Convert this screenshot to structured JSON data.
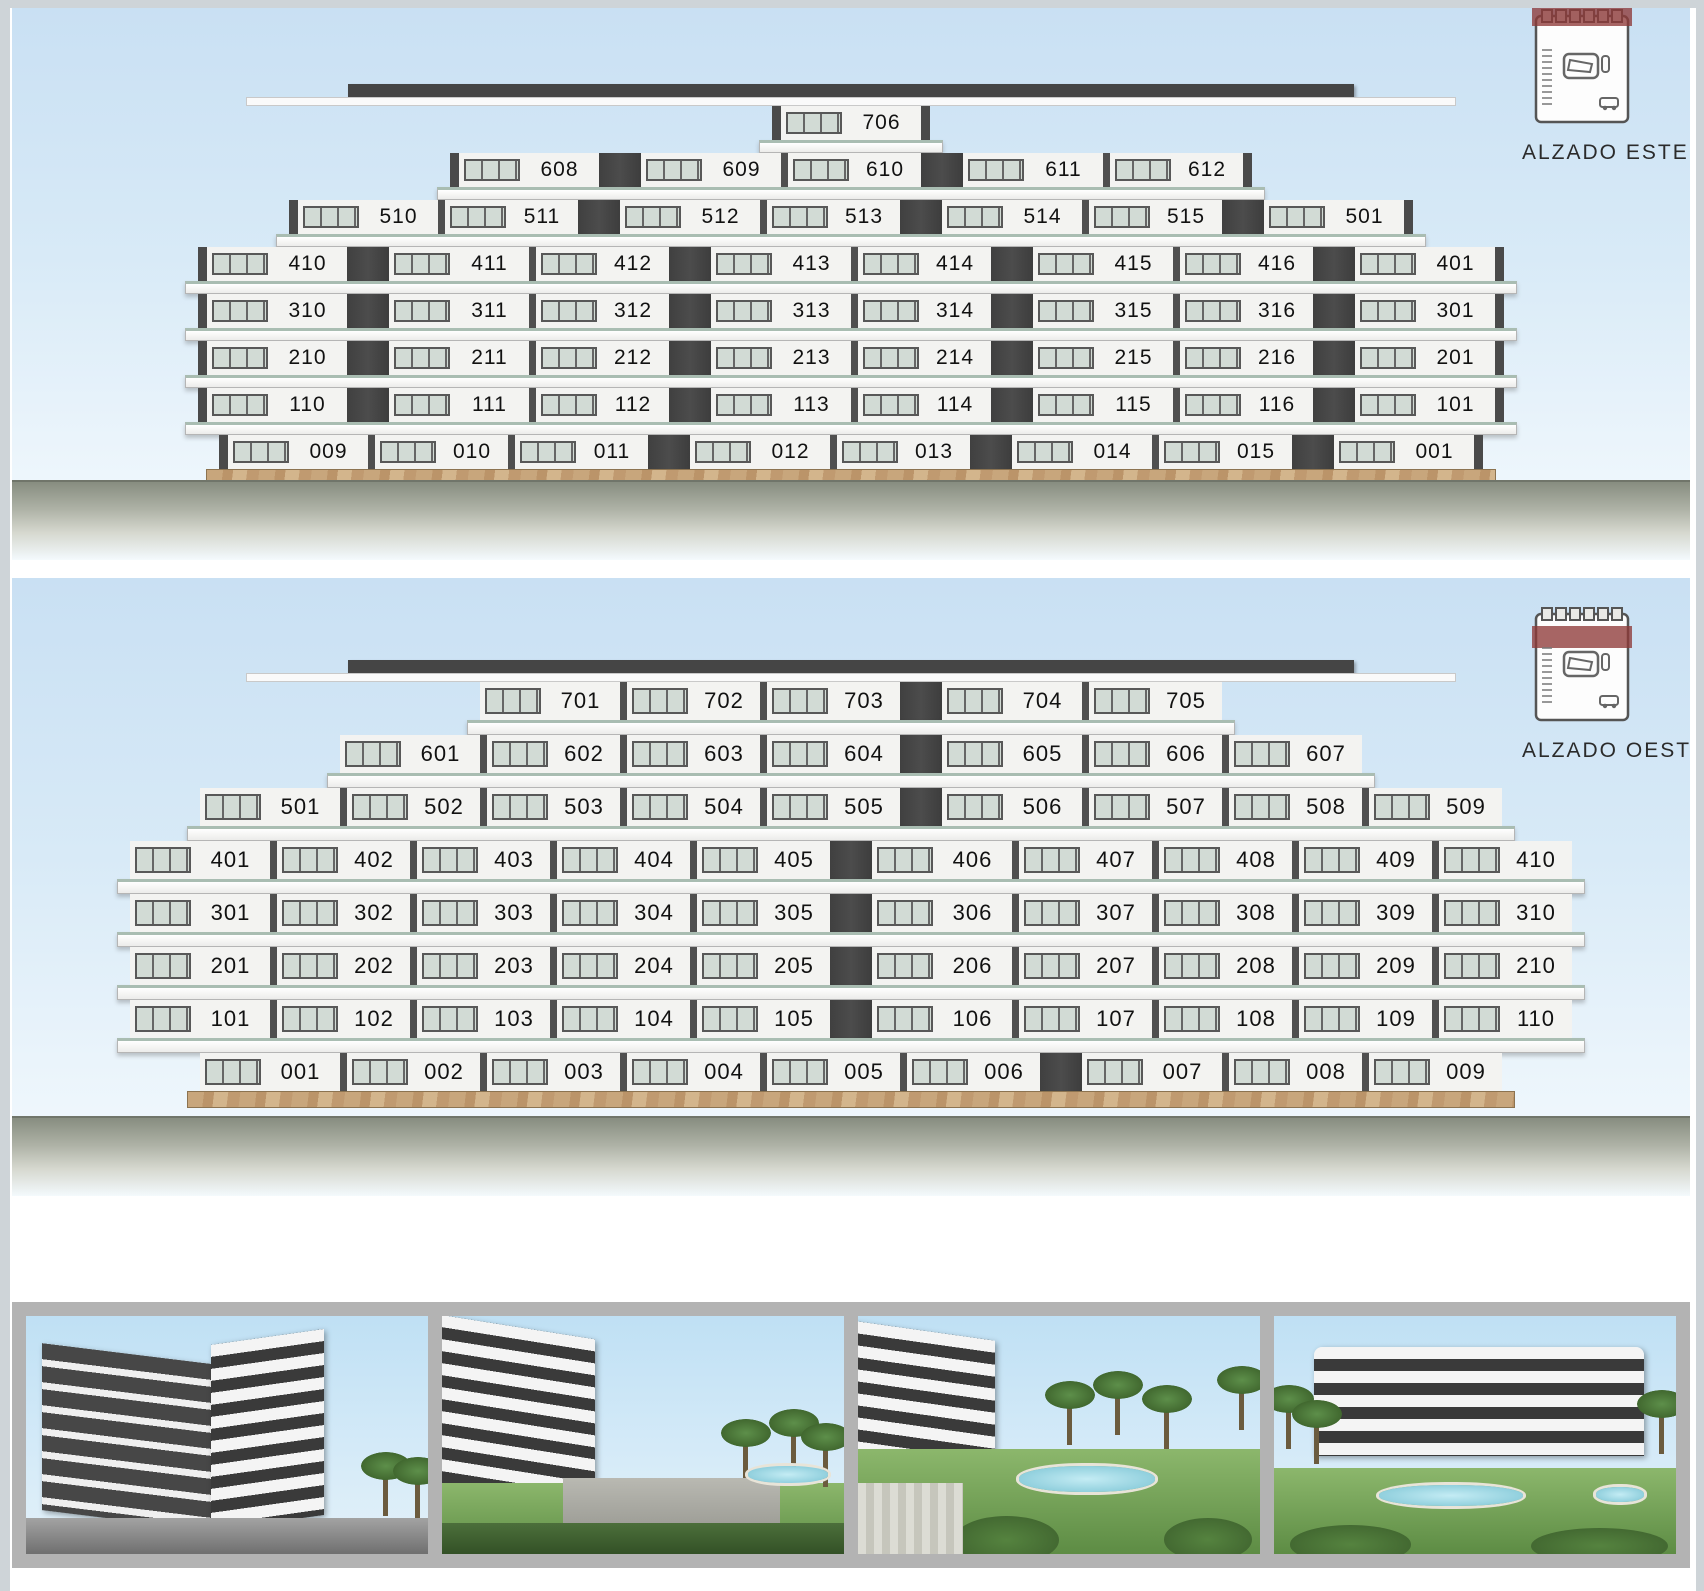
{
  "panels": [
    {
      "id": "este",
      "label": "ALZADO ESTE",
      "floors": [
        [
          "706"
        ],
        [
          "608",
          "|",
          "609",
          "610",
          "|",
          "611",
          "612"
        ],
        [
          "510",
          "511",
          "|",
          "512",
          "513",
          "|",
          "514",
          "515",
          "|",
          "501"
        ],
        [
          "410",
          "|",
          "411",
          "412",
          "|",
          "413",
          "414",
          "|",
          "415",
          "416",
          "|",
          "401"
        ],
        [
          "310",
          "|",
          "311",
          "312",
          "|",
          "313",
          "314",
          "|",
          "315",
          "316",
          "|",
          "301"
        ],
        [
          "210",
          "|",
          "211",
          "212",
          "|",
          "213",
          "214",
          "|",
          "215",
          "216",
          "|",
          "201"
        ],
        [
          "110",
          "|",
          "111",
          "112",
          "|",
          "113",
          "114",
          "|",
          "115",
          "116",
          "|",
          "101"
        ],
        [
          "009",
          "010",
          "011",
          "|",
          "012",
          "013",
          "|",
          "014",
          "015",
          "|",
          "001"
        ]
      ]
    },
    {
      "id": "oeste",
      "label": "ALZADO OESTE",
      "floors": [
        [
          "701",
          "702",
          "703",
          "|",
          "704",
          "705"
        ],
        [
          "601",
          "602",
          "603",
          "604",
          "|",
          "605",
          "606",
          "607"
        ],
        [
          "501",
          "502",
          "503",
          "504",
          "505",
          "|",
          "506",
          "507",
          "508",
          "509"
        ],
        [
          "401",
          "402",
          "403",
          "404",
          "405",
          "|",
          "406",
          "407",
          "408",
          "409",
          "410"
        ],
        [
          "301",
          "302",
          "303",
          "304",
          "305",
          "|",
          "306",
          "307",
          "308",
          "309",
          "310"
        ],
        [
          "201",
          "202",
          "203",
          "204",
          "205",
          "|",
          "206",
          "207",
          "208",
          "209",
          "210"
        ],
        [
          "101",
          "102",
          "103",
          "104",
          "105",
          "|",
          "106",
          "107",
          "108",
          "109",
          "110"
        ],
        [
          "001",
          "002",
          "003",
          "004",
          "005",
          "006",
          "|",
          "007",
          "008",
          "009"
        ]
      ]
    }
  ],
  "photos": [
    {
      "name": "street-corner-view-render"
    },
    {
      "name": "facade-promenade-render"
    },
    {
      "name": "garden-pool-render"
    },
    {
      "name": "building-with-pool-garden-render"
    }
  ],
  "colors": {
    "sky": "#cfe3f4",
    "facade_dark": "#454545",
    "facade_light": "#f3f3f1",
    "window_glass": "#ccd6d0",
    "balcony_railing": "#a9bdb2",
    "ground": "#878d80",
    "stone_base": "#c8a67c",
    "keyplan_highlight": "#8e3a39",
    "photo_strip_bg": "#b3b3b3"
  }
}
